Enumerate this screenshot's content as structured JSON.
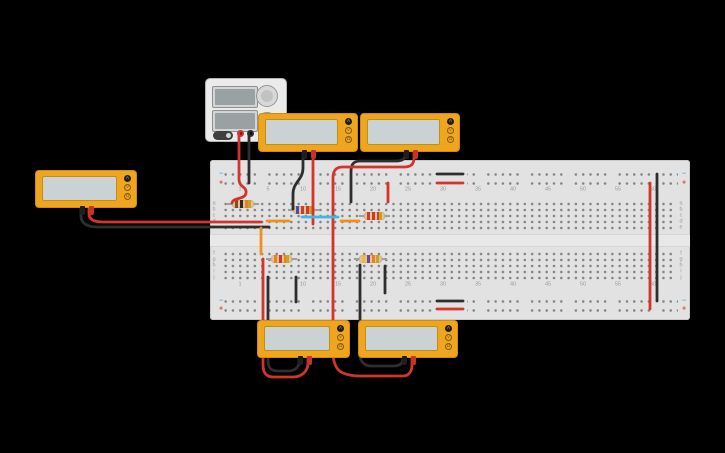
{
  "app": {
    "background": "#000000"
  },
  "colors": {
    "board": "#e2e2e2",
    "board_border": "#c9c9c9",
    "hole": "#858585",
    "label": "#9a9a9a",
    "minus": "#64a7d9",
    "plus": "#cf4a3f",
    "wire_red": "#d4342c",
    "wire_black": "#2e2e2e",
    "wire_orange": "#ef8f1e",
    "wire_cyan": "#3bb8e8",
    "mm_body": "#f0a51f",
    "mm_border": "#d18a12",
    "mm_screen": "#cbd2d4",
    "psu_body": "#ebebeb",
    "resistor_body": "#e3c396",
    "lead": "#9e9e9e"
  },
  "breadboard": {
    "x": 210,
    "y": 160,
    "w": 480,
    "h": 160,
    "groove": {
      "y": 234,
      "h": 13
    },
    "dots": {
      "x": 222,
      "w": 456,
      "bank_w": 452,
      "pitch_x": 7.3,
      "rail_bands_y": [
        170,
        297
      ],
      "rail_pitch": 9,
      "rail_h": 18,
      "bank_bands_y": [
        201,
        251
      ],
      "bank_pitch": 6,
      "bank_h": 31,
      "gap_cover": [
        [
          433,
          168,
          34,
          20
        ],
        [
          433,
          295,
          34,
          20
        ]
      ]
    },
    "col_numbers": [
      [
        "1",
        240
      ],
      [
        "5",
        268
      ],
      [
        "10",
        303
      ],
      [
        "15",
        338
      ],
      [
        "20",
        373
      ],
      [
        "25",
        408
      ],
      [
        "30",
        443
      ],
      [
        "35",
        478
      ],
      [
        "40",
        513
      ],
      [
        "45",
        548
      ],
      [
        "50",
        583
      ],
      [
        "55",
        618
      ],
      [
        "60",
        653
      ]
    ],
    "number_rows_y": [
      190,
      285
    ],
    "row_letters": [
      [
        "a",
        204
      ],
      [
        "b",
        210
      ],
      [
        "c",
        216
      ],
      [
        "d",
        222
      ],
      [
        "e",
        228
      ],
      [
        "f",
        254
      ],
      [
        "g",
        260
      ],
      [
        "h",
        266
      ],
      [
        "i",
        272
      ],
      [
        "j",
        278
      ]
    ],
    "letter_cols_x": [
      214,
      681
    ],
    "rail_marks": {
      "x": [
        221,
        684
      ],
      "minus_y": [
        174,
        301
      ],
      "plus_y": [
        183,
        309
      ],
      "minus_sign": "−",
      "plus_sign": "+"
    }
  },
  "power_supply": {
    "x": 205,
    "y": 78,
    "w": 82,
    "h": 64,
    "displays": [
      [
        6,
        7,
        46,
        22
      ],
      [
        6,
        31,
        46,
        22
      ]
    ],
    "knobs": [
      [
        61,
        17,
        11
      ],
      [
        61,
        43,
        10
      ]
    ],
    "power_button": [
      7,
      52,
      20,
      9
    ],
    "terminals": {
      "red": [
        34,
        54
      ],
      "black": [
        44,
        54
      ]
    }
  },
  "multimeters": [
    {
      "id": "left",
      "x": 35,
      "y": 170,
      "w": 102,
      "h": 38
    },
    {
      "id": "top-1",
      "x": 258,
      "y": 113,
      "w": 100,
      "h": 39
    },
    {
      "id": "top-2",
      "x": 360,
      "y": 113,
      "w": 100,
      "h": 39
    },
    {
      "id": "bottom-1",
      "x": 257,
      "y": 320,
      "w": 93,
      "h": 38
    },
    {
      "id": "bottom-2",
      "x": 358,
      "y": 320,
      "w": 100,
      "h": 38
    }
  ],
  "mm_buttons": [
    "A",
    "V",
    "Ω"
  ],
  "mm_selected": "A",
  "resistors": [
    {
      "id": "r1",
      "x": 227,
      "y": 204,
      "len": 32,
      "bands": [
        "#8a4a20",
        "#2b2b2b",
        "#e8821e",
        "#c9a227"
      ]
    },
    {
      "id": "r2",
      "x": 288,
      "y": 210,
      "len": 32,
      "bands": [
        "#3f51b5",
        "#cf3a2e",
        "#cf3a2e",
        "#c9a227"
      ]
    },
    {
      "id": "r3",
      "x": 359,
      "y": 216,
      "len": 31,
      "bands": [
        "#cf3a2e",
        "#cf3a2e",
        "#cf3a2e",
        "#c9a227"
      ]
    },
    {
      "id": "r4",
      "x": 266,
      "y": 259,
      "len": 31,
      "bands": [
        "#e8821e",
        "#cf3a2e",
        "#e8821e",
        "#c9a227"
      ]
    },
    {
      "id": "r5",
      "x": 354,
      "y": 259,
      "len": 33,
      "bands": [
        "#e6c229",
        "#7b3fa0",
        "#e8821e",
        "#c9a227"
      ]
    }
  ],
  "wires": [
    {
      "id": "psu-positive",
      "color": "wire_red",
      "d": "M 239,132 L 239,179 C 239,188 247,186 246,193 C 245,200 233,197 232,203"
    },
    {
      "id": "psu-negative",
      "color": "wire_black",
      "d": "M 249,132 L 249,183"
    },
    {
      "id": "mm-left-red-probe",
      "color": "wire_red",
      "d": "M 89,208 L 89,214 C 89,220 95,222 103,222 L 261,222"
    },
    {
      "id": "mm-left-black-probe",
      "color": "wire_black",
      "d": "M 81,208 L 81,216 C 81,224 88,227 98,227 L 269,227"
    },
    {
      "id": "mm-top-1-black-probe",
      "color": "wire_black",
      "d": "M 303,152 L 303,168 C 303,180 293,182 293,194 L 293,209"
    },
    {
      "id": "mm-top-1-red-probe",
      "color": "wire_red",
      "d": "M 313,152 L 313,224"
    },
    {
      "id": "mm-top-2-black-probe",
      "color": "wire_black",
      "d": "M 405,152 L 405,155 C 405,160 401,161 395,161 L 360,161 C 353,161 351,165 351,172 L 351,202"
    },
    {
      "id": "mm-top-2-red-probe",
      "color": "wire_red",
      "d": "M 414,152 L 414,158 C 414,165 410,167 404,167 L 342,167 C 336,167 333,171 333,178 L 333,351 C 333,363 336,370 343,373 C 348,375 353,376 359,376 L 403,376 C 409,376 412,371 412,365 L 412,358"
    },
    {
      "id": "mm-bottom-1-black-probe",
      "color": "wire_black",
      "d": "M 299,357 L 299,362 C 299,368 294,371 288,371 L 277,371 C 271,371 268,367 268,361 L 268,277"
    },
    {
      "id": "mm-bottom-1-red-probe",
      "color": "wire_red",
      "d": "M 308,357 L 308,363 C 308,371 302,377 293,377 L 273,377 C 266,377 263,372 263,365 L 263,259"
    },
    {
      "id": "mm-bottom-2-black-probe",
      "color": "wire_black",
      "d": "M 403,357 L 403,359 C 403,364 399,366 393,366 L 371,366 C 364,366 360,361 360,355 L 360,265"
    },
    {
      "id": "gap-jumper-orange",
      "color": "wire_orange",
      "d": "M 261,228 L 261,254"
    },
    {
      "id": "row-to-rail-black-left",
      "color": "wire_black",
      "d": "M 296,277 L 296,302"
    },
    {
      "id": "row-jumper-black-right",
      "color": "wire_black",
      "d": "M 385,266 L 385,293"
    },
    {
      "id": "rail-bridge-black-top",
      "color": "wire_black",
      "d": "M 437,174 L 463,174"
    },
    {
      "id": "rail-bridge-red-top",
      "color": "wire_red",
      "d": "M 437,183 L 463,183"
    },
    {
      "id": "rail-bridge-black-bottom",
      "color": "wire_black",
      "d": "M 437,301 L 463,301"
    },
    {
      "id": "rail-bridge-red-bottom",
      "color": "wire_red",
      "d": "M 437,309 L 463,309"
    },
    {
      "id": "rail-link-red-right",
      "color": "wire_red",
      "d": "M 650,183 L 650,309"
    },
    {
      "id": "rail-link-black-right",
      "color": "wire_black",
      "d": "M 657,174 L 657,301"
    },
    {
      "id": "row-d-jumper-orange-1",
      "color": "wire_orange",
      "d": "M 267,221 L 289,221"
    },
    {
      "id": "row-c-jumper-cyan",
      "color": "wire_cyan",
      "d": "M 302,217 L 338,217"
    },
    {
      "id": "row-d-jumper-orange-2",
      "color": "wire_orange",
      "d": "M 341,221 L 359,221"
    },
    {
      "id": "rail-to-row-red",
      "color": "wire_red",
      "d": "M 388,183 L 388,202"
    }
  ]
}
